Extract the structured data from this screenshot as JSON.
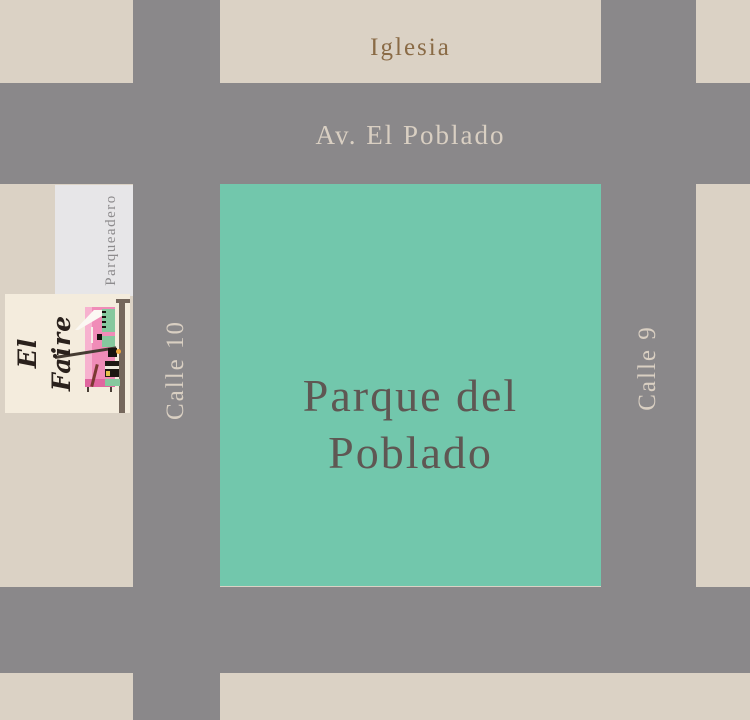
{
  "map": {
    "park": {
      "name_line1": "Parque del",
      "name_line2": "Poblado"
    },
    "labels": {
      "church": "Iglesia",
      "avenue": "Av. El Poblado",
      "street_left": "Calle 10",
      "street_right": "Calle 9",
      "parking": "Parqueadero"
    },
    "photo": {
      "brand": "El Faire"
    },
    "colors": {
      "block_beige": "#DBD2C5",
      "street_gray": "#8A888A",
      "park_green": "#72C7AC",
      "parking_white": "#E7E6E8",
      "church_text": "#8A6B46",
      "street_text": "#D9CFC2",
      "park_text": "#5F5753",
      "parking_text": "#8D8B8D",
      "photo_cream": "#F4ECDD",
      "storefront_pink": "#F08CB8",
      "storefront_mint": "#86C89E",
      "script_ink": "#2A211C"
    }
  }
}
